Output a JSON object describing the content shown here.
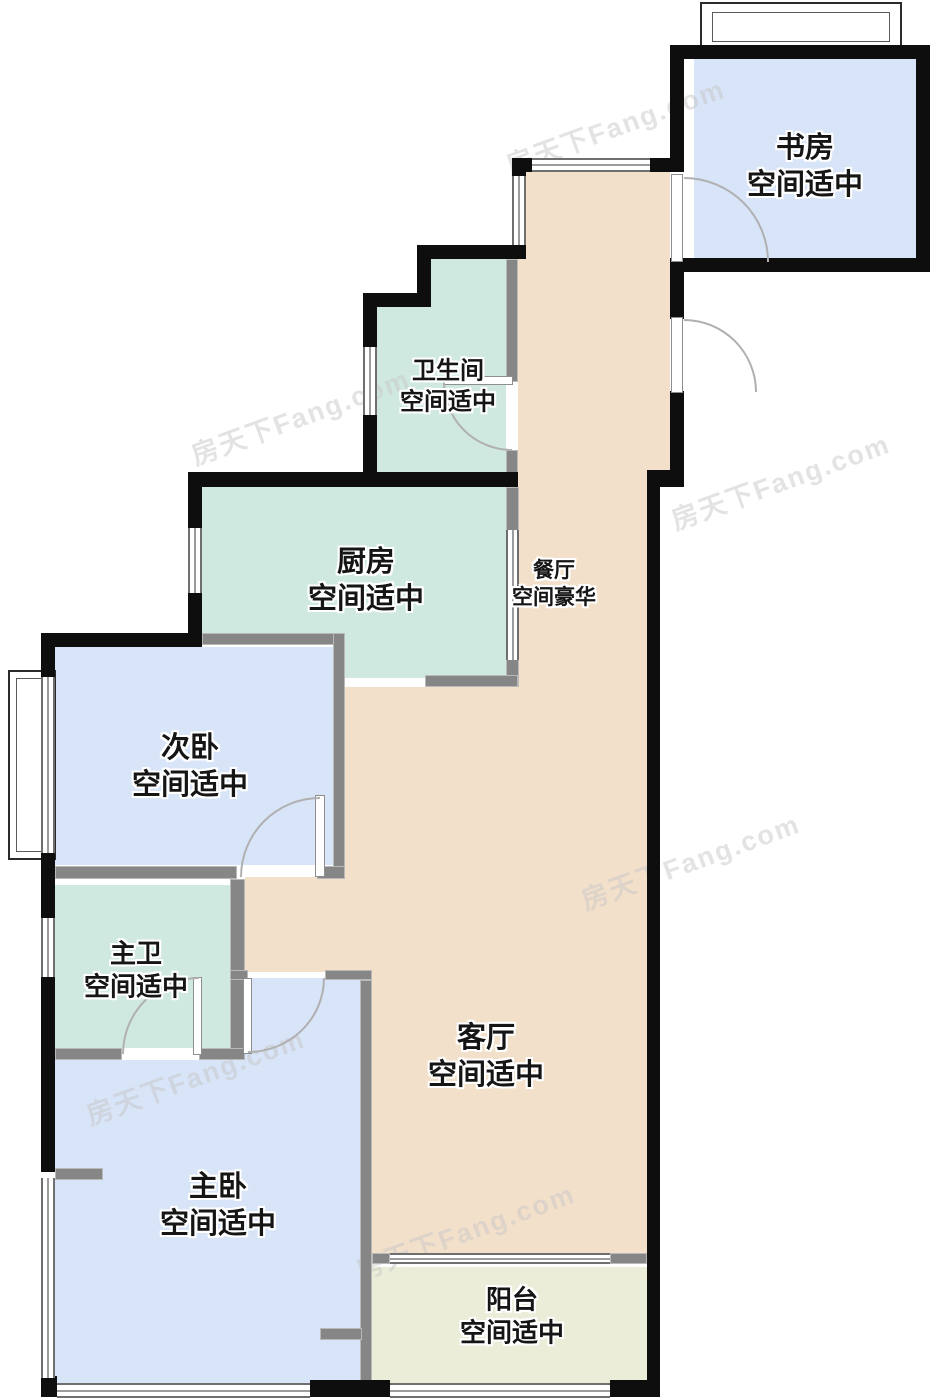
{
  "watermark": {
    "text": "房天下Fang.com"
  },
  "rooms": {
    "study": {
      "name": "书房",
      "grade": "空间适中"
    },
    "bathroom": {
      "name": "卫生间",
      "grade": "空间适中"
    },
    "kitchen": {
      "name": "厨房",
      "grade": "空间适中"
    },
    "dining": {
      "name": "餐厅",
      "grade": "空间豪华"
    },
    "second_bedroom": {
      "name": "次卧",
      "grade": "空间适中"
    },
    "master_bathroom": {
      "name": "主卫",
      "grade": "空间适中"
    },
    "living_room": {
      "name": "客厅",
      "grade": "空间适中"
    },
    "master_bedroom": {
      "name": "主卧",
      "grade": "空间适中"
    },
    "balcony": {
      "name": "阳台",
      "grade": "空间适中"
    }
  },
  "colors": {
    "bedroom_fill": "#d8e4f8",
    "bath_kitchen_fill": "#cfe9e1",
    "living_dining_fill": "#f3e0cb",
    "balcony_fill": "#ecedd9",
    "exterior_wall": "#0e0e0e",
    "interior_wall": "#868686",
    "door_arc": "#b0b0b0"
  }
}
